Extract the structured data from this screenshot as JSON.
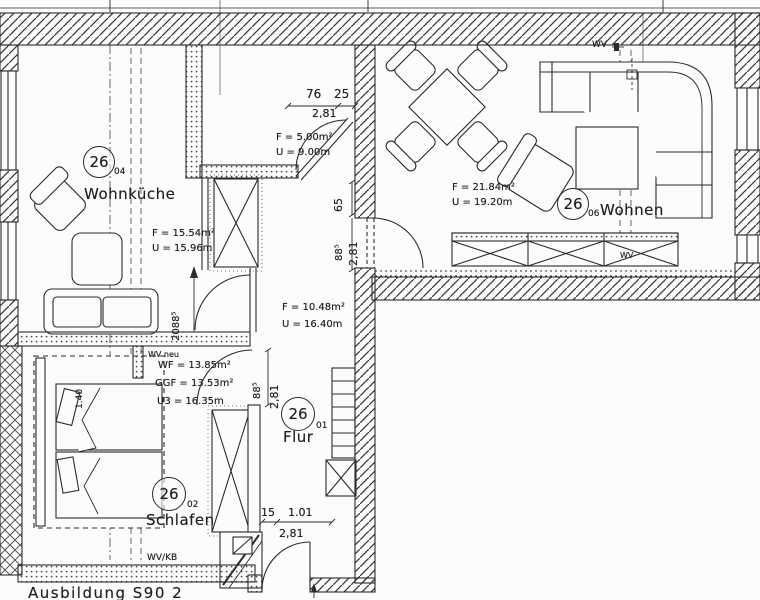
{
  "colors": {
    "line": "#2b2b2b",
    "background": "#fcfcfc"
  },
  "rooms": {
    "wohnkueche": {
      "number": "26",
      "suffix": "04",
      "name": "Wohnküche",
      "area": "F = 15.54m²",
      "perimeter": "U = 15.96m"
    },
    "bad": {
      "area": "F = 5.00m²",
      "perimeter": "U = 9.00m"
    },
    "wohnen": {
      "number": "26",
      "suffix": "06",
      "name": "Wohnen",
      "area": "F = 21.84m²",
      "perimeter": "U = 19.20m"
    },
    "flur": {
      "number": "26",
      "suffix": "01",
      "name": "Flur",
      "area": "F = 10.48m²",
      "perimeter": "U = 16.40m"
    },
    "schlafen": {
      "number": "26",
      "suffix": "02",
      "name": "Schlafen",
      "wf": "WF = 13.85m²",
      "ggf": "GGF = 13.53m²",
      "u3": "U3 = 16.35m"
    }
  },
  "dimensions": {
    "bad_seg1": "76",
    "bad_seg2": "25",
    "bad_total": "2,81",
    "wohnen_door_width": "65",
    "wohnen_door_a": "88⁵",
    "wohnen_door_b": "2,81",
    "kueche_door": "2088⁵",
    "flur_door_a": "88⁵",
    "flur_door_b": "2,81",
    "bed_width": "1.40",
    "entry_seg1": "15",
    "entry_seg2": "1.01",
    "entry_total": "2,81"
  },
  "annotations": {
    "wv": "WV",
    "wv_neu": "WV neu",
    "wv_kb": "WV/KB",
    "wv_board": "WV",
    "note": "Ausbildung S90 2"
  }
}
